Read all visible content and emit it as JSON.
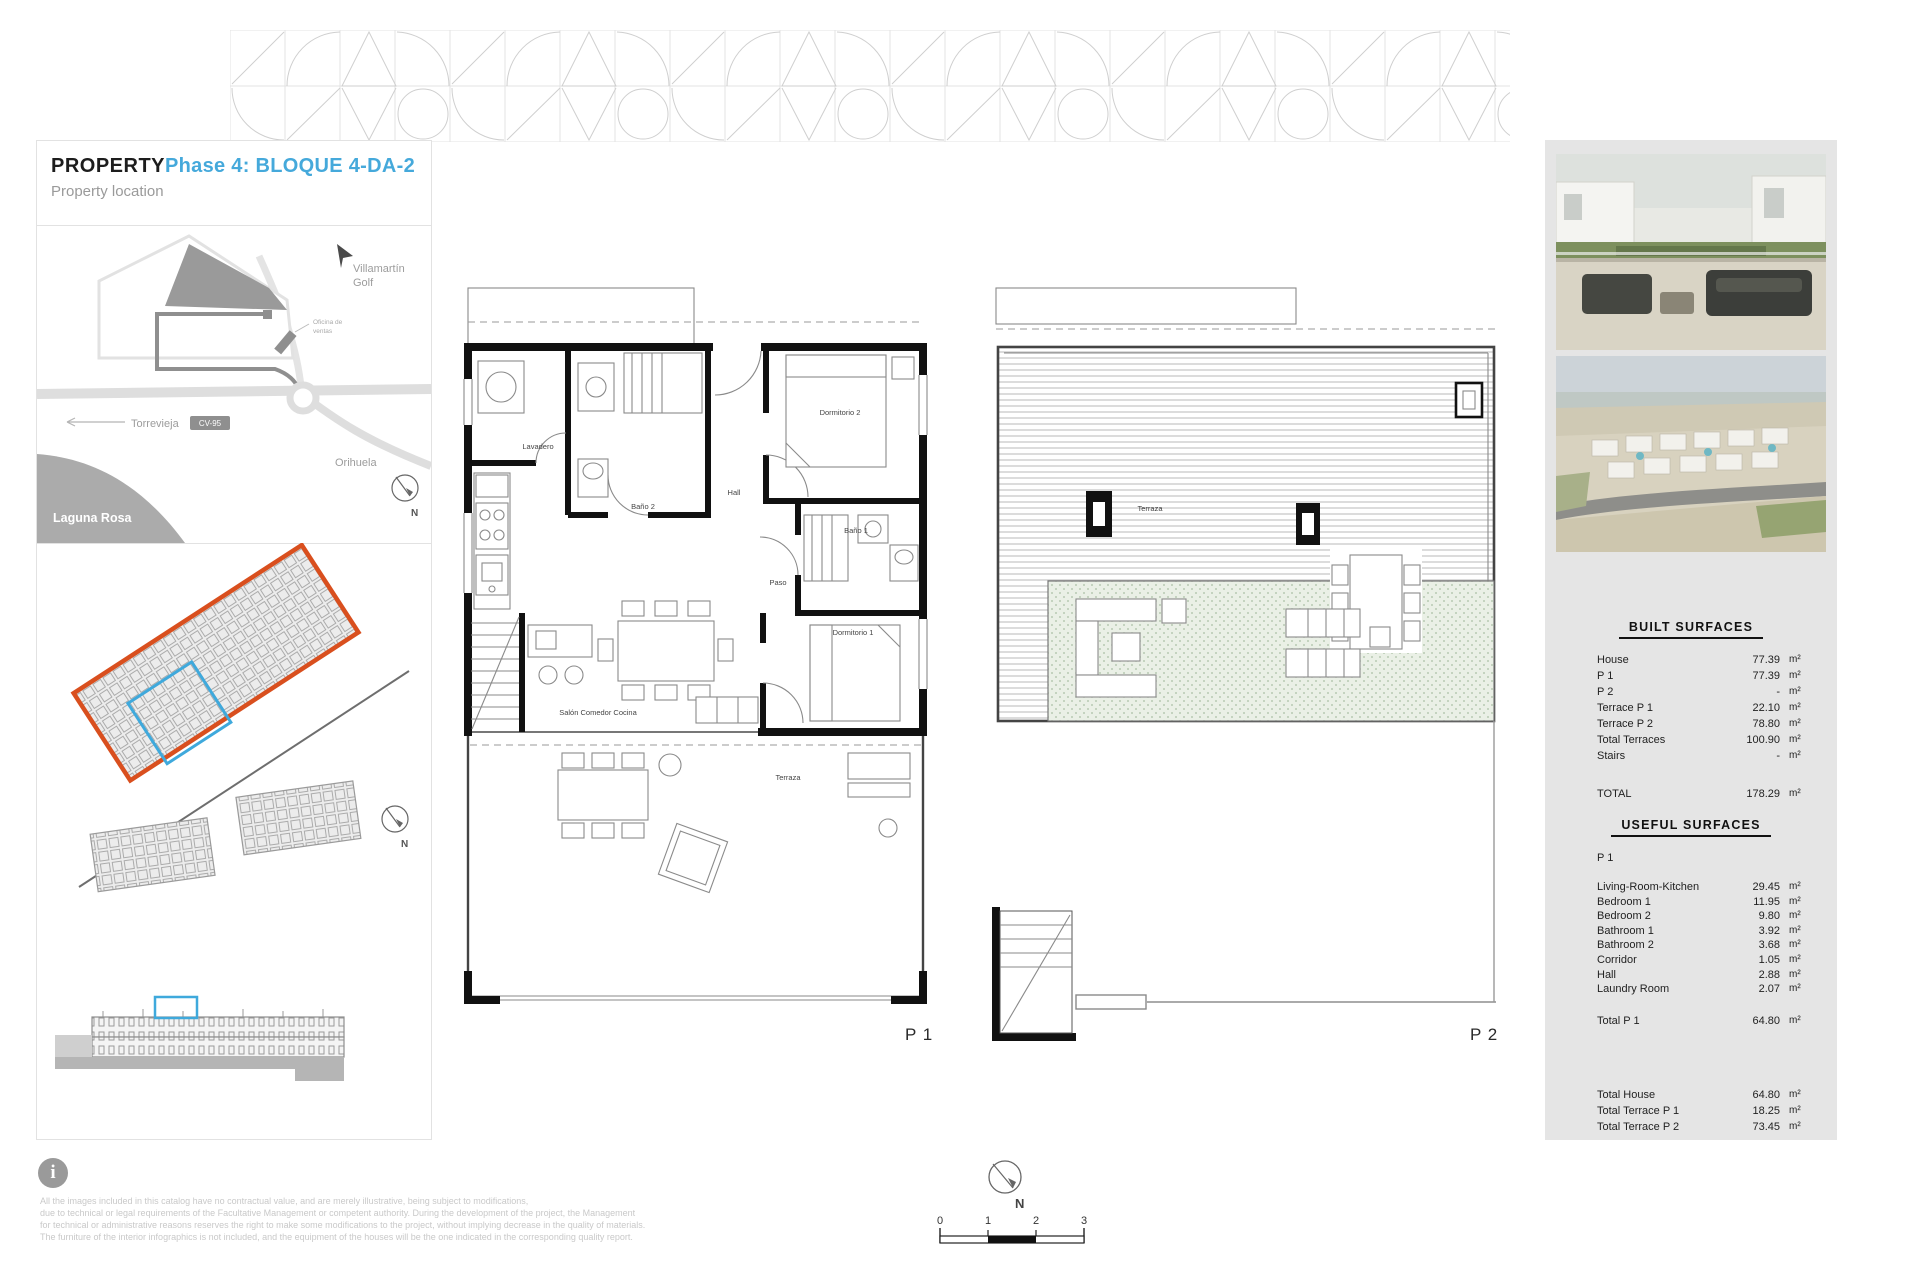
{
  "header": {
    "title": "PROPERTY",
    "phase": "Phase 4: BLOQUE 4-DA-2",
    "section": "Property location"
  },
  "map": {
    "golf_label_1": "Villamartín",
    "golf_label_2": "Golf",
    "sales_office_1": "Oficina de",
    "sales_office_2": "ventas",
    "road_left": "Torrevieja",
    "road_ref": "CV-95",
    "city_right": "Orihuela",
    "lake": "Laguna Rosa",
    "north": "N"
  },
  "site_plan": {
    "north": "N"
  },
  "plans": {
    "p1": {
      "label": "P 1",
      "rooms": {
        "laundry": "Lavadero",
        "bath2": "Baño 2",
        "hall": "Hall",
        "bed2": "Dormitorio 2",
        "corridor": "Paso",
        "bath1": "Baño 1",
        "bed1": "Dormitorio 1",
        "living": "Salón Comedor Cocina",
        "terrace": "Terraza"
      }
    },
    "p2": {
      "label": "P 2",
      "rooms": {
        "terrace": "Terraza"
      }
    }
  },
  "built_surfaces": {
    "title": "BUILT SURFACES",
    "rows": [
      {
        "label": "House",
        "value": "77.39",
        "unit": "m²"
      },
      {
        "label": "P 1",
        "value": "77.39",
        "unit": "m²"
      },
      {
        "label": "P 2",
        "value": "-",
        "unit": "m²"
      },
      {
        "label": "Terrace P 1",
        "value": "22.10",
        "unit": "m²"
      },
      {
        "label": "Terrace P 2",
        "value": "78.80",
        "unit": "m²"
      },
      {
        "label": "Total Terraces",
        "value": "100.90",
        "unit": "m²"
      },
      {
        "label": "Stairs",
        "value": "-",
        "unit": "m²"
      }
    ],
    "total": {
      "label": "TOTAL",
      "value": "178.29",
      "unit": "m²"
    }
  },
  "useful_surfaces": {
    "title": "USEFUL SURFACES",
    "floor": "P 1",
    "rows": [
      {
        "label": "Living-Room-Kitchen",
        "value": "29.45",
        "unit": "m²"
      },
      {
        "label": "Bedroom 1",
        "value": "11.95",
        "unit": "m²"
      },
      {
        "label": "Bedroom 2",
        "value": "9.80",
        "unit": "m²"
      },
      {
        "label": "Bathroom 1",
        "value": "3.92",
        "unit": "m²"
      },
      {
        "label": "Bathroom 2",
        "value": "3.68",
        "unit": "m²"
      },
      {
        "label": "Corridor",
        "value": "1.05",
        "unit": "m²"
      },
      {
        "label": "Hall",
        "value": "2.88",
        "unit": "m²"
      },
      {
        "label": "Laundry Room",
        "value": "2.07",
        "unit": "m²"
      }
    ],
    "total": {
      "label": "Total P 1",
      "value": "64.80",
      "unit": "m²"
    },
    "summary": [
      {
        "label": "Total House",
        "value": "64.80",
        "unit": "m²"
      },
      {
        "label": "Total Terrace P 1",
        "value": "18.25",
        "unit": "m²"
      },
      {
        "label": "Total Terrace P 2",
        "value": "73.45",
        "unit": "m²"
      }
    ]
  },
  "footer": {
    "info_glyph": "i",
    "disclaimer": [
      "All the images included in this catalog have no contractual value, and are merely illustrative, being subject to modifications,",
      "due to technical or legal requirements of the Facultative Management or competent authority. During the development of the project, the Management",
      "for technical or administrative reasons reserves the right to make some modifications to the project, without implying decrease in the quality of materials.",
      "The furniture of the interior infographics is not included, and the equipment of the houses will be the one indicated in the corresponding quality report."
    ],
    "scale_ticks": [
      "0",
      "1",
      "2",
      "3"
    ],
    "north": "N"
  },
  "colors": {
    "accent_blue": "#45A9DB",
    "highlight_blue": "#3FA9DC",
    "accent_orange": "#D94F1E",
    "panel_gray": "#E5E5E5"
  }
}
